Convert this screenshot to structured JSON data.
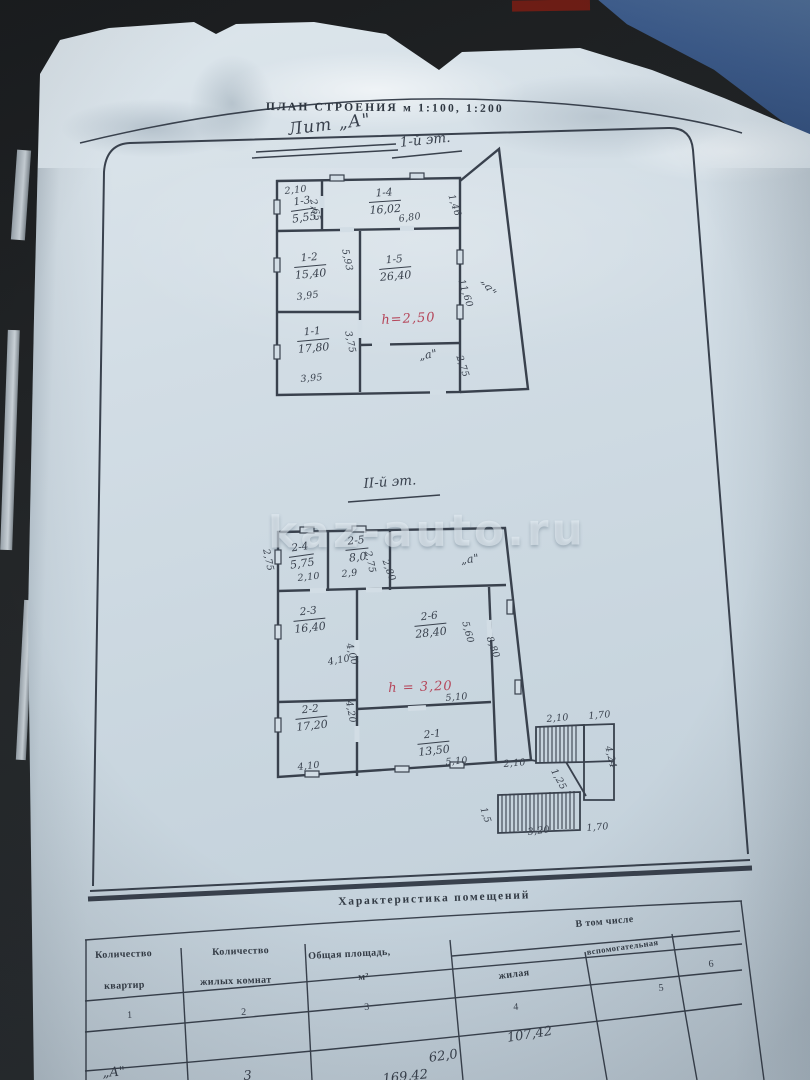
{
  "colors": {
    "paper": "#ccd8e1",
    "ink": "#39414d",
    "red_ink": "#b5465a",
    "fabric_blue": "#3d5c8c",
    "backdrop": "#1d1f21"
  },
  "watermark": {
    "text": "kaz-auto.ru",
    "x": 268,
    "y": 506
  },
  "document": {
    "title": "ПЛАН СТРОЕНИЯ м 1:100, 1:200",
    "labels": [
      {
        "n": "plan-title",
        "t": "ПЛАН СТРОЕНИЯ м 1:100, 1:200",
        "x": 266,
        "y": 101,
        "r": 0.5,
        "c": "typed"
      },
      {
        "n": "litera-label",
        "t": "Лит „А\"",
        "x": 287,
        "y": 120,
        "r": -7,
        "c": "hand big"
      },
      {
        "n": "floor1-label",
        "t": "1-й эт.",
        "x": 399,
        "y": 135,
        "r": -6,
        "c": "hand"
      },
      {
        "n": "floor2-label",
        "t": "II-й эт.",
        "x": 363,
        "y": 476,
        "r": -4,
        "c": "hand"
      }
    ]
  },
  "plan1": {
    "floor": "1-й эт.",
    "rooms": [
      {
        "n": "room-1-3",
        "id": "1-3",
        "area": "5,55",
        "x": 289,
        "y": 197,
        "r": -8
      },
      {
        "n": "room-1-4",
        "id": "1-4",
        "area": "16,02",
        "x": 368,
        "y": 188,
        "r": -4
      },
      {
        "n": "room-1-2",
        "id": "1-2",
        "area": "15,40",
        "x": 293,
        "y": 253,
        "r": -5
      },
      {
        "n": "room-1-5",
        "id": "1-5",
        "area": "26,40",
        "x": 378,
        "y": 255,
        "r": -5
      },
      {
        "n": "room-1-1",
        "id": "1-1",
        "area": "17,80",
        "x": 296,
        "y": 327,
        "r": -5
      }
    ],
    "dims": [
      {
        "t": "2,10",
        "x": 284,
        "y": 186,
        "r": -6
      },
      {
        "t": "2,65",
        "x": 318,
        "y": 198,
        "r": 78
      },
      {
        "t": "6,80",
        "x": 398,
        "y": 214,
        "r": -8
      },
      {
        "t": "1,46",
        "x": 456,
        "y": 193,
        "r": 72
      },
      {
        "t": "5,93",
        "x": 350,
        "y": 248,
        "r": 78
      },
      {
        "t": "3,95",
        "x": 296,
        "y": 292,
        "r": -7
      },
      {
        "t": "11,60",
        "x": 466,
        "y": 278,
        "r": 72
      },
      {
        "t": "„а\"",
        "x": 490,
        "y": 276,
        "r": 60,
        "c": "hand sm"
      },
      {
        "t": "3,75",
        "x": 353,
        "y": 330,
        "r": 78
      },
      {
        "t": "„а\"",
        "x": 418,
        "y": 350,
        "r": -10,
        "c": "hand sm"
      },
      {
        "t": "3,95",
        "x": 300,
        "y": 374,
        "r": -5
      },
      {
        "t": "2,75",
        "x": 464,
        "y": 354,
        "r": 72
      }
    ],
    "notes": [
      {
        "n": "height-note-floor1",
        "t": "h=2,50",
        "x": 381,
        "y": 313,
        "r": -3
      }
    ]
  },
  "plan2": {
    "floor": "II-й эт.",
    "rooms": [
      {
        "n": "room-2-4",
        "id": "2-4",
        "area": "5,75",
        "x": 287,
        "y": 543,
        "r": -8
      },
      {
        "n": "room-2-5",
        "id": "2-5",
        "area": "8,0",
        "x": 344,
        "y": 536,
        "r": -6
      },
      {
        "n": "room-2-3",
        "id": "2-3",
        "area": "16,40",
        "x": 292,
        "y": 607,
        "r": -6
      },
      {
        "n": "room-2-6",
        "id": "2-6",
        "area": "28,40",
        "x": 413,
        "y": 612,
        "r": -6
      },
      {
        "n": "room-2-2",
        "id": "2-2",
        "area": "17,20",
        "x": 294,
        "y": 705,
        "r": -6
      },
      {
        "n": "room-2-1",
        "id": "2-1",
        "area": "13,50",
        "x": 416,
        "y": 730,
        "r": -6
      }
    ],
    "dims": [
      {
        "t": "2,75",
        "x": 271,
        "y": 548,
        "r": 78
      },
      {
        "t": "2,10",
        "x": 297,
        "y": 573,
        "r": -6
      },
      {
        "t": "2,9",
        "x": 341,
        "y": 569,
        "r": -6
      },
      {
        "t": "2,75",
        "x": 373,
        "y": 550,
        "r": 78
      },
      {
        "t": "2,80",
        "x": 390,
        "y": 558,
        "r": 70
      },
      {
        "t": "„а\"",
        "x": 460,
        "y": 554,
        "r": -8,
        "c": "hand sm"
      },
      {
        "t": "4,10",
        "x": 327,
        "y": 657,
        "r": -10
      },
      {
        "t": "4,00",
        "x": 354,
        "y": 642,
        "r": 75
      },
      {
        "t": "5,60",
        "x": 470,
        "y": 620,
        "r": 75
      },
      {
        "t": "8,80",
        "x": 494,
        "y": 635,
        "r": 70
      },
      {
        "t": "5,10",
        "x": 445,
        "y": 693,
        "r": -5
      },
      {
        "t": "4,20",
        "x": 354,
        "y": 700,
        "r": 80
      },
      {
        "t": "4,10",
        "x": 297,
        "y": 762,
        "r": -6
      },
      {
        "t": "5,10",
        "x": 445,
        "y": 757,
        "r": -5
      },
      {
        "t": "2,10",
        "x": 503,
        "y": 759,
        "r": -5
      }
    ],
    "notes": [
      {
        "n": "height-note-floor2",
        "t": "h = 3,20",
        "x": 388,
        "y": 681,
        "r": -2
      }
    ]
  },
  "stairs": {
    "dims": [
      {
        "t": "2,10",
        "x": 546,
        "y": 714,
        "r": -5
      },
      {
        "t": "1,70",
        "x": 588,
        "y": 711,
        "r": -5
      },
      {
        "t": "1,25",
        "x": 558,
        "y": 767,
        "r": 62
      },
      {
        "t": "4,24",
        "x": 613,
        "y": 745,
        "r": 76
      },
      {
        "t": "3,20",
        "x": 527,
        "y": 827,
        "r": -7
      },
      {
        "t": "1,70",
        "x": 586,
        "y": 823,
        "r": -5
      },
      {
        "t": "1,5",
        "x": 488,
        "y": 806,
        "r": 72
      }
    ]
  },
  "table": {
    "caption": "Характеристика помещений",
    "group_header": "В том числе",
    "labels": [
      {
        "n": "table-caption",
        "t": "Характеристика помещений",
        "x": 338,
        "y": 896,
        "r": -2,
        "c": "cap"
      },
      {
        "n": "group-header",
        "t": "В том числе",
        "x": 575,
        "y": 919,
        "r": -5
      },
      {
        "n": "col1-header-line1",
        "t": "Количество",
        "x": 95,
        "y": 950,
        "r": -2
      },
      {
        "n": "col1-header-line2",
        "t": "квартир",
        "x": 104,
        "y": 981,
        "r": -2
      },
      {
        "n": "col2-header-line1",
        "t": "Количество",
        "x": 212,
        "y": 947,
        "r": -2
      },
      {
        "n": "col2-header-line2",
        "t": "жилых комнат",
        "x": 200,
        "y": 977,
        "r": -2
      },
      {
        "n": "col3-header-line1",
        "t": "Общая площадь,",
        "x": 308,
        "y": 951,
        "r": -3
      },
      {
        "n": "col3-header-line2",
        "t": "м²",
        "x": 358,
        "y": 972,
        "r": -3
      },
      {
        "n": "col4-header",
        "t": "жилая",
        "x": 498,
        "y": 971,
        "r": -7
      },
      {
        "n": "col5-header",
        "t": "вспомогательная",
        "x": 586,
        "y": 947,
        "r": -8,
        "c": "small"
      }
    ],
    "numbers": [
      {
        "n": "col1-number",
        "t": "1",
        "x": 127,
        "y": 1010,
        "r": -2
      },
      {
        "n": "col2-number",
        "t": "2",
        "x": 241,
        "y": 1007,
        "r": -2
      },
      {
        "n": "col3-number",
        "t": "3",
        "x": 364,
        "y": 1002,
        "r": -3
      },
      {
        "n": "col4-number",
        "t": "4",
        "x": 513,
        "y": 1002,
        "r": -4
      },
      {
        "n": "col5-number",
        "t": "5",
        "x": 658,
        "y": 983,
        "r": -6
      },
      {
        "n": "col6-number",
        "t": "6",
        "x": 708,
        "y": 959,
        "r": -6
      }
    ],
    "row": [
      {
        "n": "row-litera-value",
        "t": "„А\"",
        "x": 102,
        "y": 1066,
        "r": -4
      },
      {
        "n": "row-rooms-value",
        "t": "3",
        "x": 243,
        "y": 1069,
        "r": -4
      },
      {
        "n": "row-total-area-value",
        "t": "169,42",
        "x": 382,
        "y": 1072,
        "r": -6
      },
      {
        "n": "row-living-area-value",
        "t": "62,0",
        "x": 428,
        "y": 1051,
        "r": -8
      },
      {
        "n": "row-auxiliary-area-value",
        "t": "107,42",
        "x": 506,
        "y": 1031,
        "r": -9
      }
    ]
  }
}
